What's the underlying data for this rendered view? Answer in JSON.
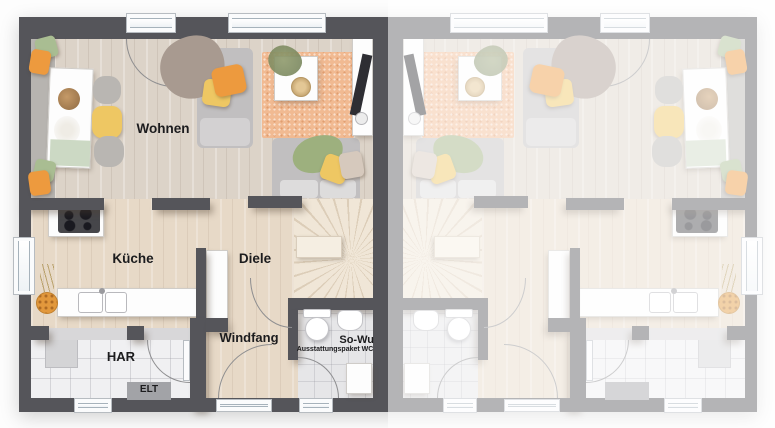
{
  "rooms": {
    "wohnen": {
      "label": "Wohnen"
    },
    "kueche": {
      "label": "Küche"
    },
    "diele": {
      "label": "Diele"
    },
    "windfang": {
      "label": "Windfang"
    },
    "har": {
      "label": "HAR"
    },
    "elt": {
      "label": "ELT"
    },
    "so_wu": {
      "label": "So-Wu",
      "sublabel": "Ausstattungspaket WC"
    }
  },
  "colors": {
    "wall": "#55555a",
    "faded_wall": "#aaaaac",
    "floor_wood_living": "#dcd3c8",
    "floor_wood_hall": "#e7d9c7",
    "floor_tile": "#f0f0f2",
    "rug": "#f1ba92",
    "stairs_tread": "#ece0cf",
    "pillow_orange": "#ed9a3e",
    "pillow_yellow": "#eec763",
    "pillow_green": "#a9bd92",
    "sofa_gray": "#c1bfc0",
    "label_text": "#1c1c1e"
  }
}
